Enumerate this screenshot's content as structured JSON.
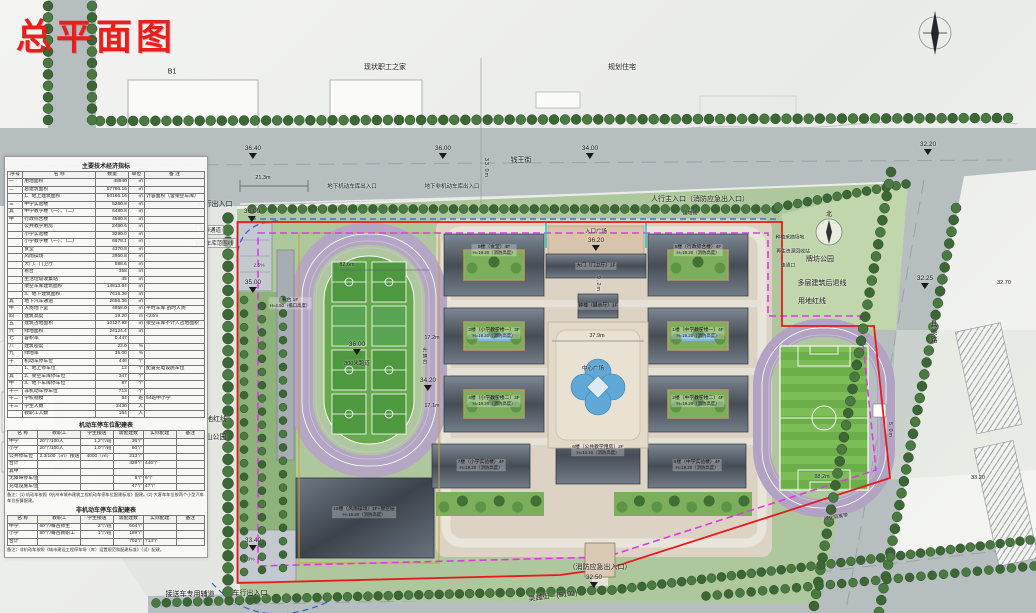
{
  "title": "总平面图",
  "colors": {
    "red_line": "#e81a1a",
    "setback_line": "#e23ae2",
    "blue_line": "#2d5fd0",
    "track": "#b5a6c4",
    "grass": "#6cae49"
  },
  "context": {
    "b1": "B1",
    "staff_home": "现状职工之家",
    "planned_residence": "规划住宅",
    "yuanbaoshan_park": "元宝山公园",
    "paifang_park": "牌坊公园",
    "north_char": "北"
  },
  "roads": {
    "north": "钱王街",
    "east": "具美路",
    "south": "吴越街—(S102)"
  },
  "entrances": {
    "vehicle_north": "车行出入口",
    "underground_motor": "地下机动车库出入口",
    "underground_nonmotor": "地下非机动车库出入口",
    "pedestrian_main": "人行主入口（消防应急出入口）",
    "entry_plaza": "入口广场",
    "fire_emergency_south": "（消防应急出入口）",
    "shuttle_lane": "接送车专用辅道",
    "vehicle_south": "车行出入口"
  },
  "site_labels": {
    "underpass": "下穿通道",
    "garage_range_line": "架空车库范围线",
    "red_line_west": "用地红线",
    "red_line_east": "用地红线",
    "setback_line_east": "多层建筑后退线",
    "wall_line": "围墙线",
    "planting_area": "种植采摘场地",
    "recycle_station": "再生资源回收站",
    "connect_port": "连通口",
    "central_plaza": "中心广场",
    "flag_platform": "升旗台",
    "track_300": "300米跑道",
    "green_buffer": "绿化隔离带"
  },
  "levels": {
    "l3640": "36.40",
    "l3600a": "36.00",
    "l3400": "34.00",
    "l3220": "32.20",
    "l3600b": "36.00",
    "l3500": "35.00",
    "l3600c": "36.00",
    "l3420": "34.20",
    "l3620": "36.20",
    "l3340": "33.40",
    "l3250": "32.50",
    "l3225": "32.25",
    "l3270": "32.70",
    "l3320": "33.20"
  },
  "dimensions": {
    "d21": "21.3m",
    "d33": "33.0m",
    "d82": "82.6m",
    "d88": "88.2m",
    "d379": "37.9m",
    "d92": "9.2m",
    "d172": "17.2m",
    "d171": "17.1m",
    "d50": "5.0m",
    "slope25": "2.5%",
    "slope20": "2.0%"
  },
  "buildings": [
    {
      "label": "9楼（食堂）4F",
      "height": "H=19.20（消防高度）"
    },
    {
      "label": "5楼（行政综合楼）4F",
      "height": "H=19.20（消防高度）"
    },
    {
      "label": "大门（门卫厅）1F",
      "height": ""
    },
    {
      "label": "钟楼（展示厅）1F",
      "height": ""
    },
    {
      "label": "3楼（小学教学楼一）3F",
      "height": "H=19.20（消防高度）"
    },
    {
      "label": "4楼（小学教学楼二）3F",
      "height": "H=19.20（消防高度）"
    },
    {
      "label": "1楼（中学教学楼一）4F",
      "height": "H=19.20（消防高度）"
    },
    {
      "label": "2楼（中学教学楼二）4F",
      "height": "H=19.20（消防高度）"
    },
    {
      "label": "7楼（小学实验楼）4F",
      "height": "H=19.20（消防高度）"
    },
    {
      "label": "6楼（公共教学用房）2F",
      "height": "H=13.10（消防高度）"
    },
    {
      "label": "8楼（中学实验楼）4F",
      "height": "H=19.20（消防高度）"
    },
    {
      "label": "10楼（风雨操场）1F+架空层",
      "height": "H=19.20（消防高度）"
    },
    {
      "label": "看台 1F",
      "height": "H=4.50（檐口高度）"
    }
  ],
  "tables": {
    "main": {
      "title": "主要技术经济指标",
      "headers": [
        "序号",
        "名  称",
        "数量",
        "单位",
        "备  注"
      ],
      "rows": [
        [
          "一",
          "用地面积",
          "48940",
          "㎡",
          ""
        ],
        [
          "二",
          "总建筑面积",
          "57786.16",
          "㎡",
          ""
        ],
        [
          "",
          "1、地上建筑面积",
          "50166.16",
          "㎡",
          "计容面积（含架空车库）"
        ],
        [
          "三",
          "中学实验楼",
          "5260.8",
          "㎡",
          ""
        ],
        [
          "其",
          "中学教学楼（一）、（二）",
          "6480.8",
          "㎡",
          ""
        ],
        [
          "中",
          "行政综合楼",
          "4580.8",
          "㎡",
          ""
        ],
        [
          "",
          "公共教学用房",
          "2480.6",
          "㎡",
          ""
        ],
        [
          "",
          "小学实验楼",
          "3290.0",
          "㎡",
          ""
        ],
        [
          "",
          "小学教学楼（一）、（二）",
          "6678.1",
          "㎡",
          ""
        ],
        [
          "",
          "食堂",
          "4370.8",
          "㎡",
          ""
        ],
        [
          "",
          "风雨操场",
          "2950.8",
          "㎡",
          ""
        ],
        [
          "",
          "大门、门卫厅",
          "588.6",
          "㎡",
          ""
        ],
        [
          "",
          "看台",
          "358",
          "㎡",
          ""
        ],
        [
          "",
          "生活垃圾收集站",
          "45",
          "㎡",
          ""
        ],
        [
          "",
          "架空车库建筑面积",
          "14813.64",
          "㎡",
          ""
        ],
        [
          "",
          "3、地下建筑面积",
          "7616.36",
          "㎡",
          ""
        ],
        [
          "其",
          "地下汽车通道",
          "2656.36",
          "㎡",
          ""
        ],
        [
          "中",
          "人防地下室",
          "4858.0",
          "㎡",
          "平时车库 战时人防"
        ],
        [
          "四",
          "建筑高度",
          "19.20",
          "m",
          "<24m"
        ],
        [
          "五",
          "建筑占地面积",
          "10127.93",
          "㎡",
          "架空车库不计入占地面积"
        ],
        [
          "六",
          "绿地面积",
          "24124.4",
          "㎡",
          ""
        ],
        [
          "七",
          "容积率",
          "0.447",
          "",
          ""
        ],
        [
          "八",
          "建筑密度",
          "22.0",
          "%",
          ""
        ],
        [
          "九",
          "绿地率",
          "35.00",
          "%",
          ""
        ],
        [
          "十",
          "机动车停车位",
          "446",
          "个",
          ""
        ],
        [
          "",
          "1、地上停车位",
          "12",
          "个",
          "配置充电设施车位"
        ],
        [
          "其",
          "2、架空车库停车位",
          "347",
          "个",
          ""
        ],
        [
          "中",
          "3、地下车库停车位",
          "87",
          "个",
          ""
        ],
        [
          "十一",
          "非机动车停车位",
          "713",
          "个",
          ""
        ],
        [
          "十二",
          "学校规模",
          "54",
          "班",
          "54班中小学"
        ],
        [
          "十三",
          "学生人数",
          "2430",
          "人",
          ""
        ],
        [
          "",
          "教职工人数",
          "164",
          "人",
          ""
        ]
      ]
    },
    "motor": {
      "title": "机动车停车位配建表",
      "headers": [
        "名  称",
        "教职工",
        "学生接送",
        "需配建数",
        "实际配建",
        "备注"
      ],
      "rows": [
        [
          "中学",
          "20个/100人",
          "1.2个/班",
          "36个",
          "",
          ""
        ],
        [
          "小学",
          "20个/100人",
          "1.0个/班",
          "60个",
          "",
          ""
        ],
        [
          "公共停车位",
          "2.3/100（㎡）接送面积",
          "4000（㎡）",
          "213个",
          "",
          ""
        ],
        [
          "合计",
          "",
          "",
          "329个",
          "446个",
          ""
        ],
        [
          "其中",
          "",
          "",
          "",
          "",
          ""
        ],
        [
          "无障碍停车位",
          "",
          "",
          "6个",
          "6个",
          ""
        ],
        [
          "充电设施车位",
          "",
          "",
          "47个",
          "47个",
          ""
        ]
      ],
      "note": "备注：(1) 机动车按照《杭州市城市建筑工程机动车停车位配建标准》配建。(2) 大客车车位按两个小型汽车车位折算配建。"
    },
    "nonmotor": {
      "title": "非机动车停车位配建表",
      "headers": [
        "名  称",
        "教职工",
        "学生接送",
        "需配建数",
        "实际配建",
        "备注"
      ],
      "rows": [
        [
          "中学",
          "60个/每百师生",
          "2个/班",
          "504个",
          "",
          ""
        ],
        [
          "小学",
          "80个/每百教职工",
          "1个/班",
          "189个",
          "",
          ""
        ],
        [
          "合计",
          "",
          "",
          "702个",
          "713个",
          ""
        ]
      ],
      "note": "备注：非机动车按照《城市建设工程停车场（库）设置规范和配建标准》（试）配建。"
    }
  }
}
